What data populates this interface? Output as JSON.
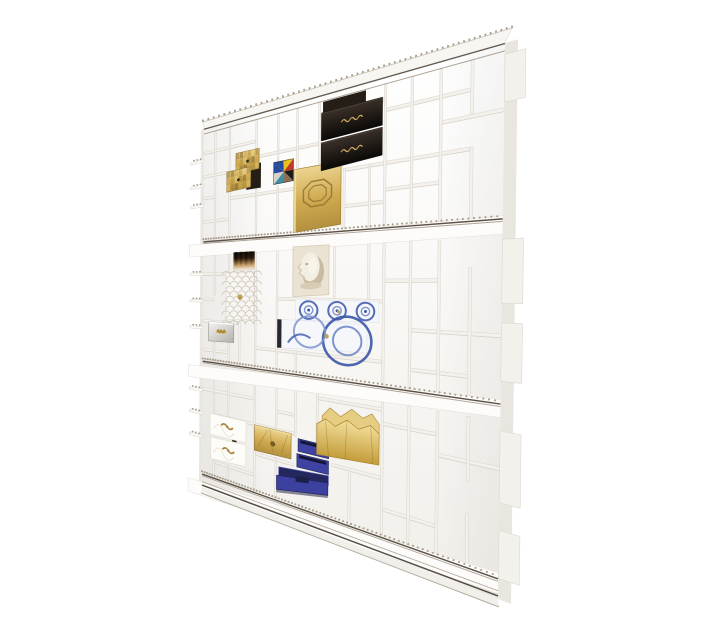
{
  "scene": {
    "description": "white modular collector shelving unit photographed at an angle on a plain white background",
    "background": "#ffffff",
    "palette": {
      "shelf_white": "#fdfcfa",
      "board_fill": "#f4f1ec",
      "board_edge": "#d9d3ca",
      "side_shade": "#e9e5df",
      "trim_dark": "#4a3f34",
      "trim_soft": "#9b8d7d",
      "stud_metal": "#a89c8b",
      "slot_dark": "#241e17",
      "gold": "#c8a550",
      "gold_deep": "#a8862f",
      "gold_pale": "#ecd490",
      "black_lacquer": "#15100c",
      "royal_blue": "#3e43a1",
      "blue_dark": "#23265c",
      "azulejo_blue": "#3b55a8",
      "azulejo_light": "#7f93cc",
      "silver": "#c9c7c3",
      "relief_cream": "#eae2d2"
    },
    "quad": {
      "tl": [
        204,
        129
      ],
      "tr": [
        505,
        43
      ],
      "br": [
        498,
        599
      ],
      "bl": [
        202,
        487
      ]
    },
    "bands": [
      [
        0.312,
        0.345
      ],
      [
        0.645,
        0.678
      ],
      [
        0.962,
        1.0
      ]
    ],
    "top_band_v": 0.014,
    "dividers": [
      [
        0.055,
        0.014,
        0.312
      ],
      [
        0.125,
        0.014,
        0.312
      ],
      [
        0.245,
        0.014,
        0.085
      ],
      [
        0.245,
        0.19,
        0.312
      ],
      [
        0.335,
        0.014,
        0.13
      ],
      [
        0.335,
        0.19,
        0.312
      ],
      [
        0.41,
        0.014,
        0.155
      ],
      [
        0.49,
        0.014,
        0.155
      ],
      [
        0.575,
        0.014,
        0.04
      ],
      [
        0.575,
        0.175,
        0.312
      ],
      [
        0.655,
        0.175,
        0.312
      ],
      [
        0.7,
        0.014,
        0.312
      ],
      [
        0.775,
        0.014,
        0.312
      ],
      [
        0.85,
        0.014,
        0.312
      ],
      [
        0.925,
        0.014,
        0.115
      ],
      [
        0.925,
        0.175,
        0.312
      ],
      [
        0.055,
        0.345,
        0.463
      ],
      [
        0.055,
        0.59,
        0.645
      ],
      [
        0.125,
        0.345,
        0.398
      ],
      [
        0.125,
        0.59,
        0.645
      ],
      [
        0.175,
        0.53,
        0.645
      ],
      [
        0.245,
        0.345,
        0.645
      ],
      [
        0.335,
        0.345,
        0.645
      ],
      [
        0.41,
        0.59,
        0.645
      ],
      [
        0.545,
        0.345,
        0.463
      ],
      [
        0.655,
        0.345,
        0.463
      ],
      [
        0.7,
        0.345,
        0.645
      ],
      [
        0.775,
        0.345,
        0.645
      ],
      [
        0.85,
        0.345,
        0.645
      ],
      [
        0.925,
        0.4,
        0.645
      ],
      [
        0.055,
        0.678,
        0.785
      ],
      [
        0.055,
        0.915,
        0.962
      ],
      [
        0.125,
        0.678,
        0.785
      ],
      [
        0.125,
        0.915,
        0.962
      ],
      [
        0.245,
        0.678,
        0.962
      ],
      [
        0.335,
        0.678,
        0.787
      ],
      [
        0.335,
        0.858,
        0.962
      ],
      [
        0.41,
        0.678,
        0.795
      ],
      [
        0.49,
        0.678,
        0.795
      ],
      [
        0.6,
        0.84,
        0.962
      ],
      [
        0.7,
        0.678,
        0.962
      ],
      [
        0.775,
        0.678,
        0.962
      ],
      [
        0.85,
        0.678,
        0.962
      ],
      [
        0.925,
        0.678,
        0.8
      ],
      [
        0.925,
        0.86,
        0.962
      ]
    ],
    "shelves": [
      [
        0.042,
        0.49,
        0.7
      ],
      [
        0.065,
        0,
        0.245
      ],
      [
        0.065,
        0.7,
        0.925
      ],
      [
        0.105,
        0.245,
        0.49
      ],
      [
        0.115,
        0.85,
        1
      ],
      [
        0.13,
        0,
        0.125
      ],
      [
        0.175,
        0.575,
        0.775
      ],
      [
        0.175,
        0.775,
        0.925
      ],
      [
        0.19,
        0,
        0.055
      ],
      [
        0.2,
        0.125,
        0.4
      ],
      [
        0.23,
        0.7,
        0.85
      ],
      [
        0.255,
        0,
        0.125
      ],
      [
        0.255,
        0.575,
        0.7
      ],
      [
        0.4,
        0,
        0.245
      ],
      [
        0.42,
        0.7,
        0.85
      ],
      [
        0.463,
        0.335,
        0.7
      ],
      [
        0.47,
        0,
        0.055
      ],
      [
        0.52,
        0.775,
        1
      ],
      [
        0.53,
        0,
        0.175
      ],
      [
        0.59,
        0.245,
        0.7
      ],
      [
        0.61,
        0,
        0.125
      ],
      [
        0.6,
        0.775,
        0.925
      ],
      [
        0.69,
        0.49,
        0.7
      ],
      [
        0.72,
        0,
        0.245
      ],
      [
        0.72,
        0.7,
        0.85
      ],
      [
        0.74,
        0.335,
        0.41
      ],
      [
        0.76,
        0.85,
        1
      ],
      [
        0.785,
        0.055,
        0.41
      ],
      [
        0.835,
        0.545,
        0.7
      ],
      [
        0.86,
        0.245,
        0.41
      ],
      [
        0.915,
        0.055,
        0.245
      ],
      [
        0.9,
        0.7,
        0.85
      ]
    ],
    "dark_slots": [
      [
        0.505,
        0.016,
        0.645,
        0.04
      ],
      [
        0.205,
        0.125,
        0.268,
        0.188
      ],
      [
        0.148,
        0.79,
        0.168,
        0.872
      ]
    ],
    "left_tabs": [
      0.085,
      0.155,
      0.21,
      0.4,
      0.475,
      0.55,
      0.725,
      0.79,
      0.855
    ],
    "right_boxes": [
      [
        0.02,
        0.105
      ],
      [
        0.35,
        0.465
      ],
      [
        0.5,
        0.605
      ],
      [
        0.695,
        0.825
      ],
      [
        0.875,
        0.962
      ]
    ],
    "items": [
      {
        "name": "striped-art-panel",
        "type": "stripe_art",
        "u": [
          0.148,
          0.245
        ],
        "v": [
          0.347,
          0.396
        ]
      },
      {
        "name": "cherub-relief-panel",
        "type": "face_relief",
        "u": [
          0.4,
          0.53
        ],
        "v": [
          0.342,
          0.461
        ]
      },
      {
        "name": "fishscale-drawer-panel",
        "type": "fishscale",
        "u": [
          0.114,
          0.242
        ],
        "v": [
          0.4,
          0.527
        ]
      },
      {
        "name": "azulejo-tile-drawer-small",
        "type": "azulejo_small",
        "u": [
          0.41,
          0.69
        ],
        "v": [
          0.467,
          0.517
        ]
      },
      {
        "name": "azulejo-tile-drawer-large",
        "type": "azulejo_large",
        "u": [
          0.34,
          0.655
        ],
        "v": [
          0.517,
          0.587
        ]
      },
      {
        "name": "mirror-drawer",
        "type": "mirror",
        "u": [
          0.03,
          0.152
        ],
        "v": [
          0.535,
          0.588
        ]
      },
      {
        "name": "gold-mosaic-drawer-box",
        "type": "gold_mosaic",
        "u": [
          0.115,
          0.26
        ],
        "v": [
          0.088,
          0.186
        ]
      },
      {
        "name": "triangle-artwork",
        "type": "triangle_art",
        "u": [
          0.322,
          0.398
        ],
        "v": [
          0.132,
          0.185
        ]
      },
      {
        "name": "gold-emblem-door",
        "type": "gold_panel",
        "u": [
          0.402,
          0.568
        ],
        "v": [
          0.158,
          0.308
        ]
      },
      {
        "name": "black-lacquer-drawers",
        "type": "black_drawers",
        "u": [
          0.5,
          0.695
        ],
        "v": [
          0.04,
          0.172
        ]
      },
      {
        "name": "white-filigree-drawers",
        "type": "filigree",
        "u": [
          0.04,
          0.202
        ],
        "v": [
          0.787,
          0.912
        ]
      },
      {
        "name": "creased-brass-drawer",
        "type": "brass_drawer",
        "u": [
          0.248,
          0.398
        ],
        "v": [
          0.79,
          0.855
        ]
      },
      {
        "name": "royal-blue-drawers",
        "type": "blue_drawers",
        "u": [
          0.335,
          0.538
        ],
        "v": [
          0.798,
          0.955
        ]
      },
      {
        "name": "crumpled-gold-box",
        "type": "gold_crumpled",
        "u": [
          0.488,
          0.7
        ],
        "v": [
          0.692,
          0.828
        ]
      }
    ]
  }
}
